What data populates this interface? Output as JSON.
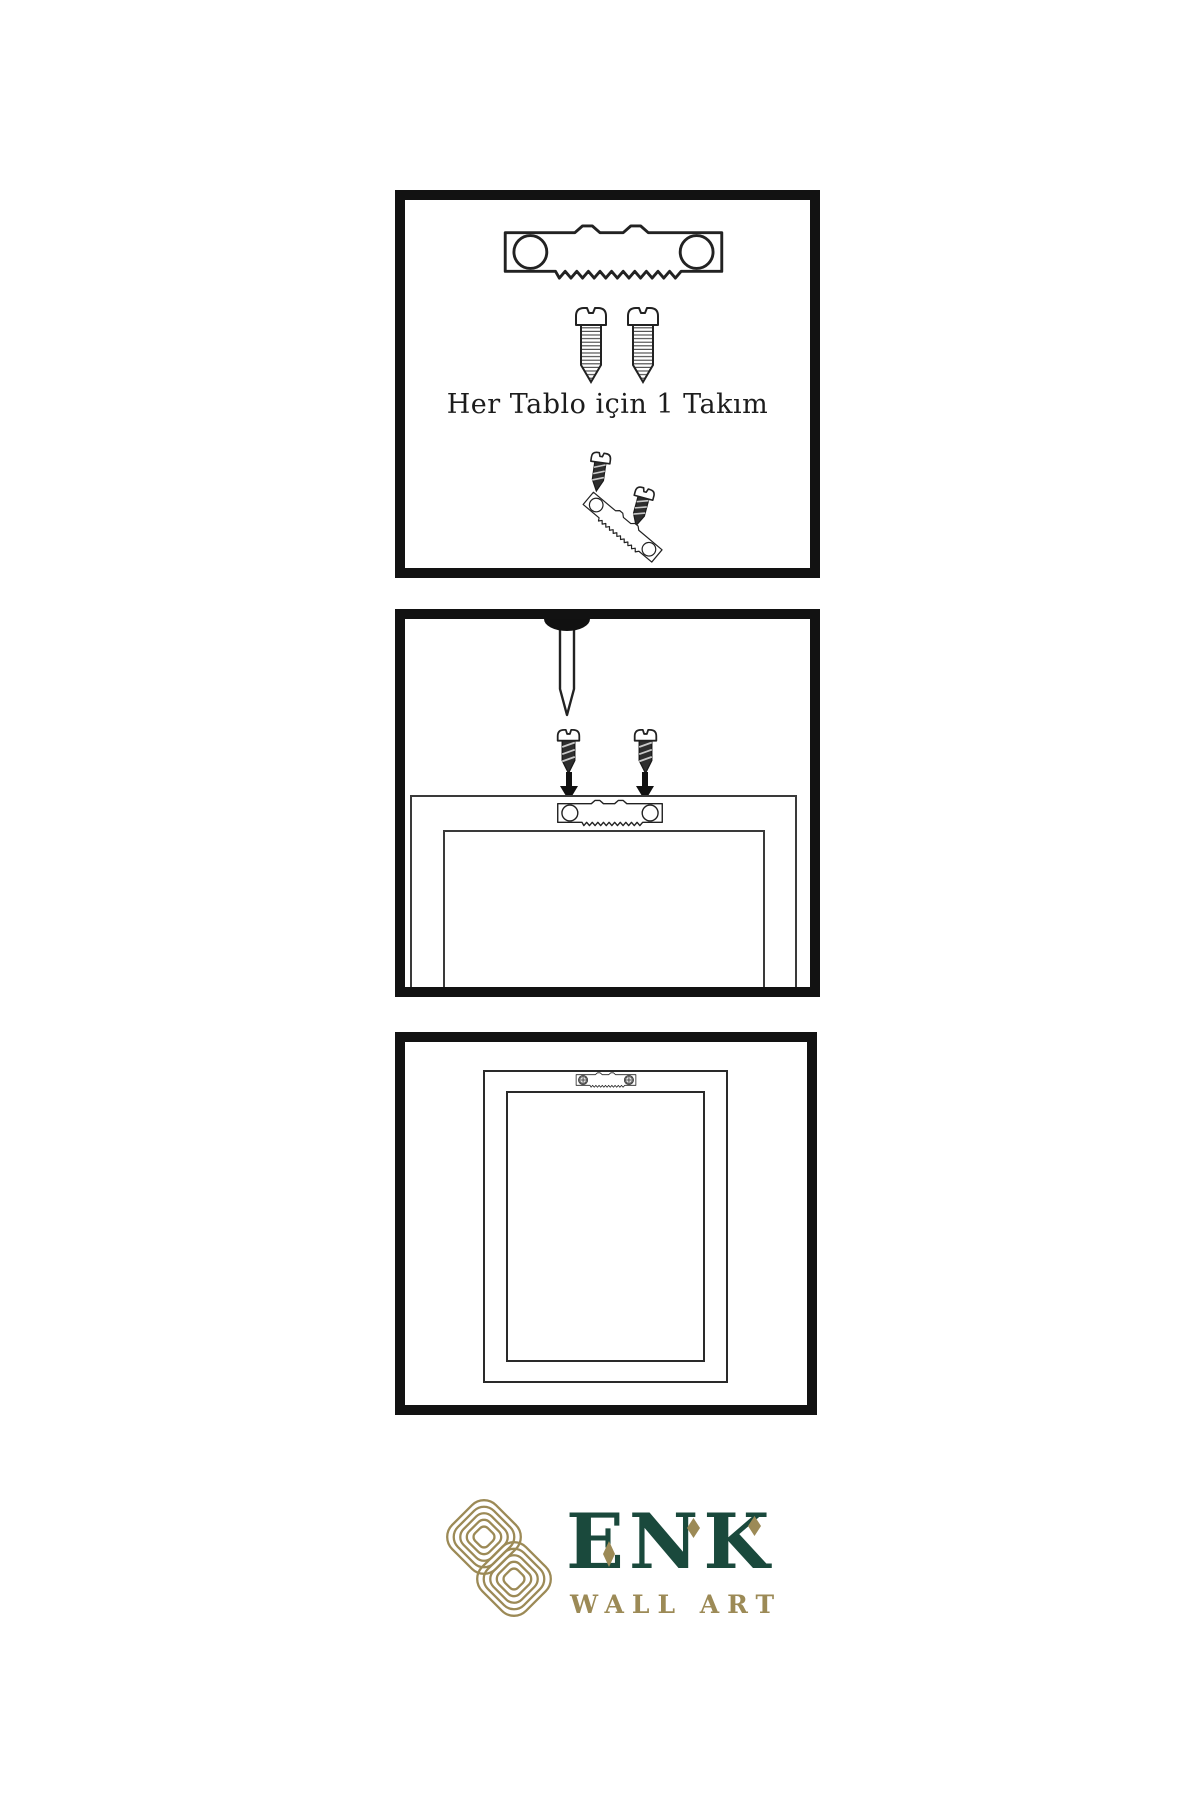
{
  "colors": {
    "background": "#ffffff",
    "panel_border": "#121212",
    "line": "#222222",
    "metal_dark": "#2e2e2e",
    "gold": "#9c8a56",
    "green": "#1a493c"
  },
  "panels": {
    "kit": {
      "caption": "Her Tablo için 1 Takım"
    },
    "mount": {},
    "hung": {}
  },
  "logo": {
    "brand": "ENK",
    "subtitle": "WALL ART"
  }
}
